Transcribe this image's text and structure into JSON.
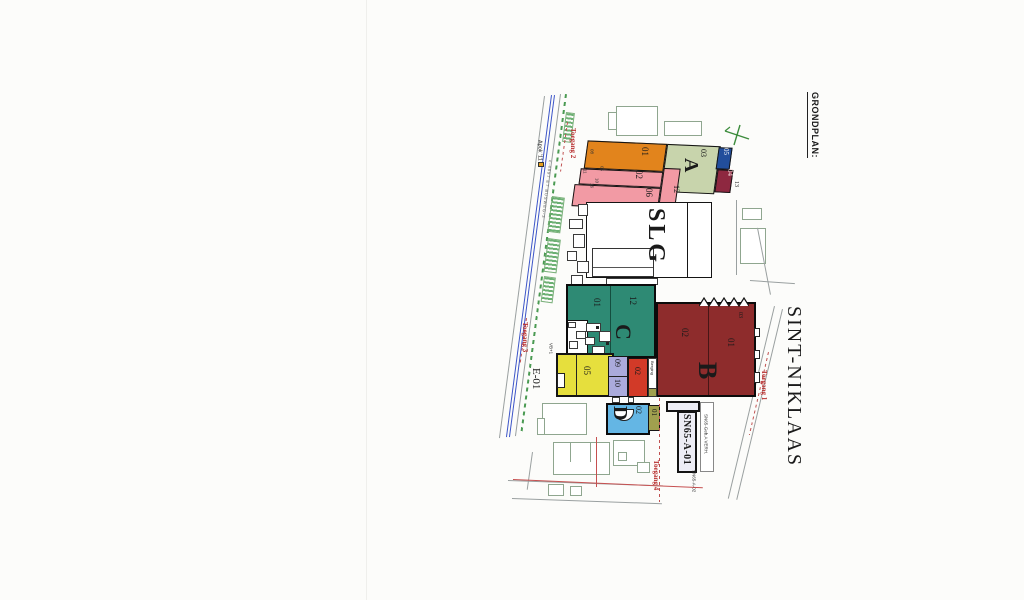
{
  "title": "GRONDPLAN:",
  "city": "SINT-NIKLAAS",
  "entrances": {
    "t1": "Toegang 1",
    "t2": "Toegang 2",
    "t3": "Toegang 3",
    "t4": "Toegang 4"
  },
  "roads": {
    "street_note": "Apok '11",
    "busweg": "c-4897  E7  BUSWEG-3"
  },
  "blocks": {
    "a": {
      "letter": "A",
      "u01": "01",
      "u02": "02",
      "u06": "06",
      "u12": "12",
      "u03": "03",
      "u05": "05",
      "u04": "04",
      "u13": "13",
      "edge": {
        "e08": "08",
        "e05": "05",
        "e11": "11",
        "e10": "10",
        "e16": "16"
      }
    },
    "slg": {
      "label": "SLG"
    },
    "b": {
      "letter": "B",
      "u01": "01",
      "u02": "02",
      "u03": "03"
    },
    "c": {
      "letter": "C",
      "u01": "01",
      "u12": "12",
      "note_vb": "VB+1",
      "note_14": "14"
    },
    "yellow": {
      "u05": "05"
    },
    "lav": {
      "u09": "09",
      "u10": "10"
    },
    "red": {
      "u02": "02",
      "berging": "Berging"
    },
    "d": {
      "letter": "D",
      "u02": "02"
    },
    "olive": {
      "u01": "01"
    },
    "e01": {
      "label": "E-01"
    },
    "sn65": {
      "main": "SN65-A-01",
      "side": "SN65-Geb.A VERH.",
      "bottom": "SN65-A-02"
    }
  },
  "colors": {
    "orange": "#E2841C",
    "pink": "#F29AA4",
    "sage": "#C8D4AC",
    "navy": "#224E9C",
    "crimson": "#8E2840",
    "brick": "#8E2C2C",
    "teal": "#2E8A74",
    "yellow": "#E6DF3D",
    "lavender": "#ABABDC",
    "red": "#D23A28",
    "lightblue": "#64B6E4",
    "olive": "#A0A04E",
    "entrance_text": "#B83030"
  }
}
